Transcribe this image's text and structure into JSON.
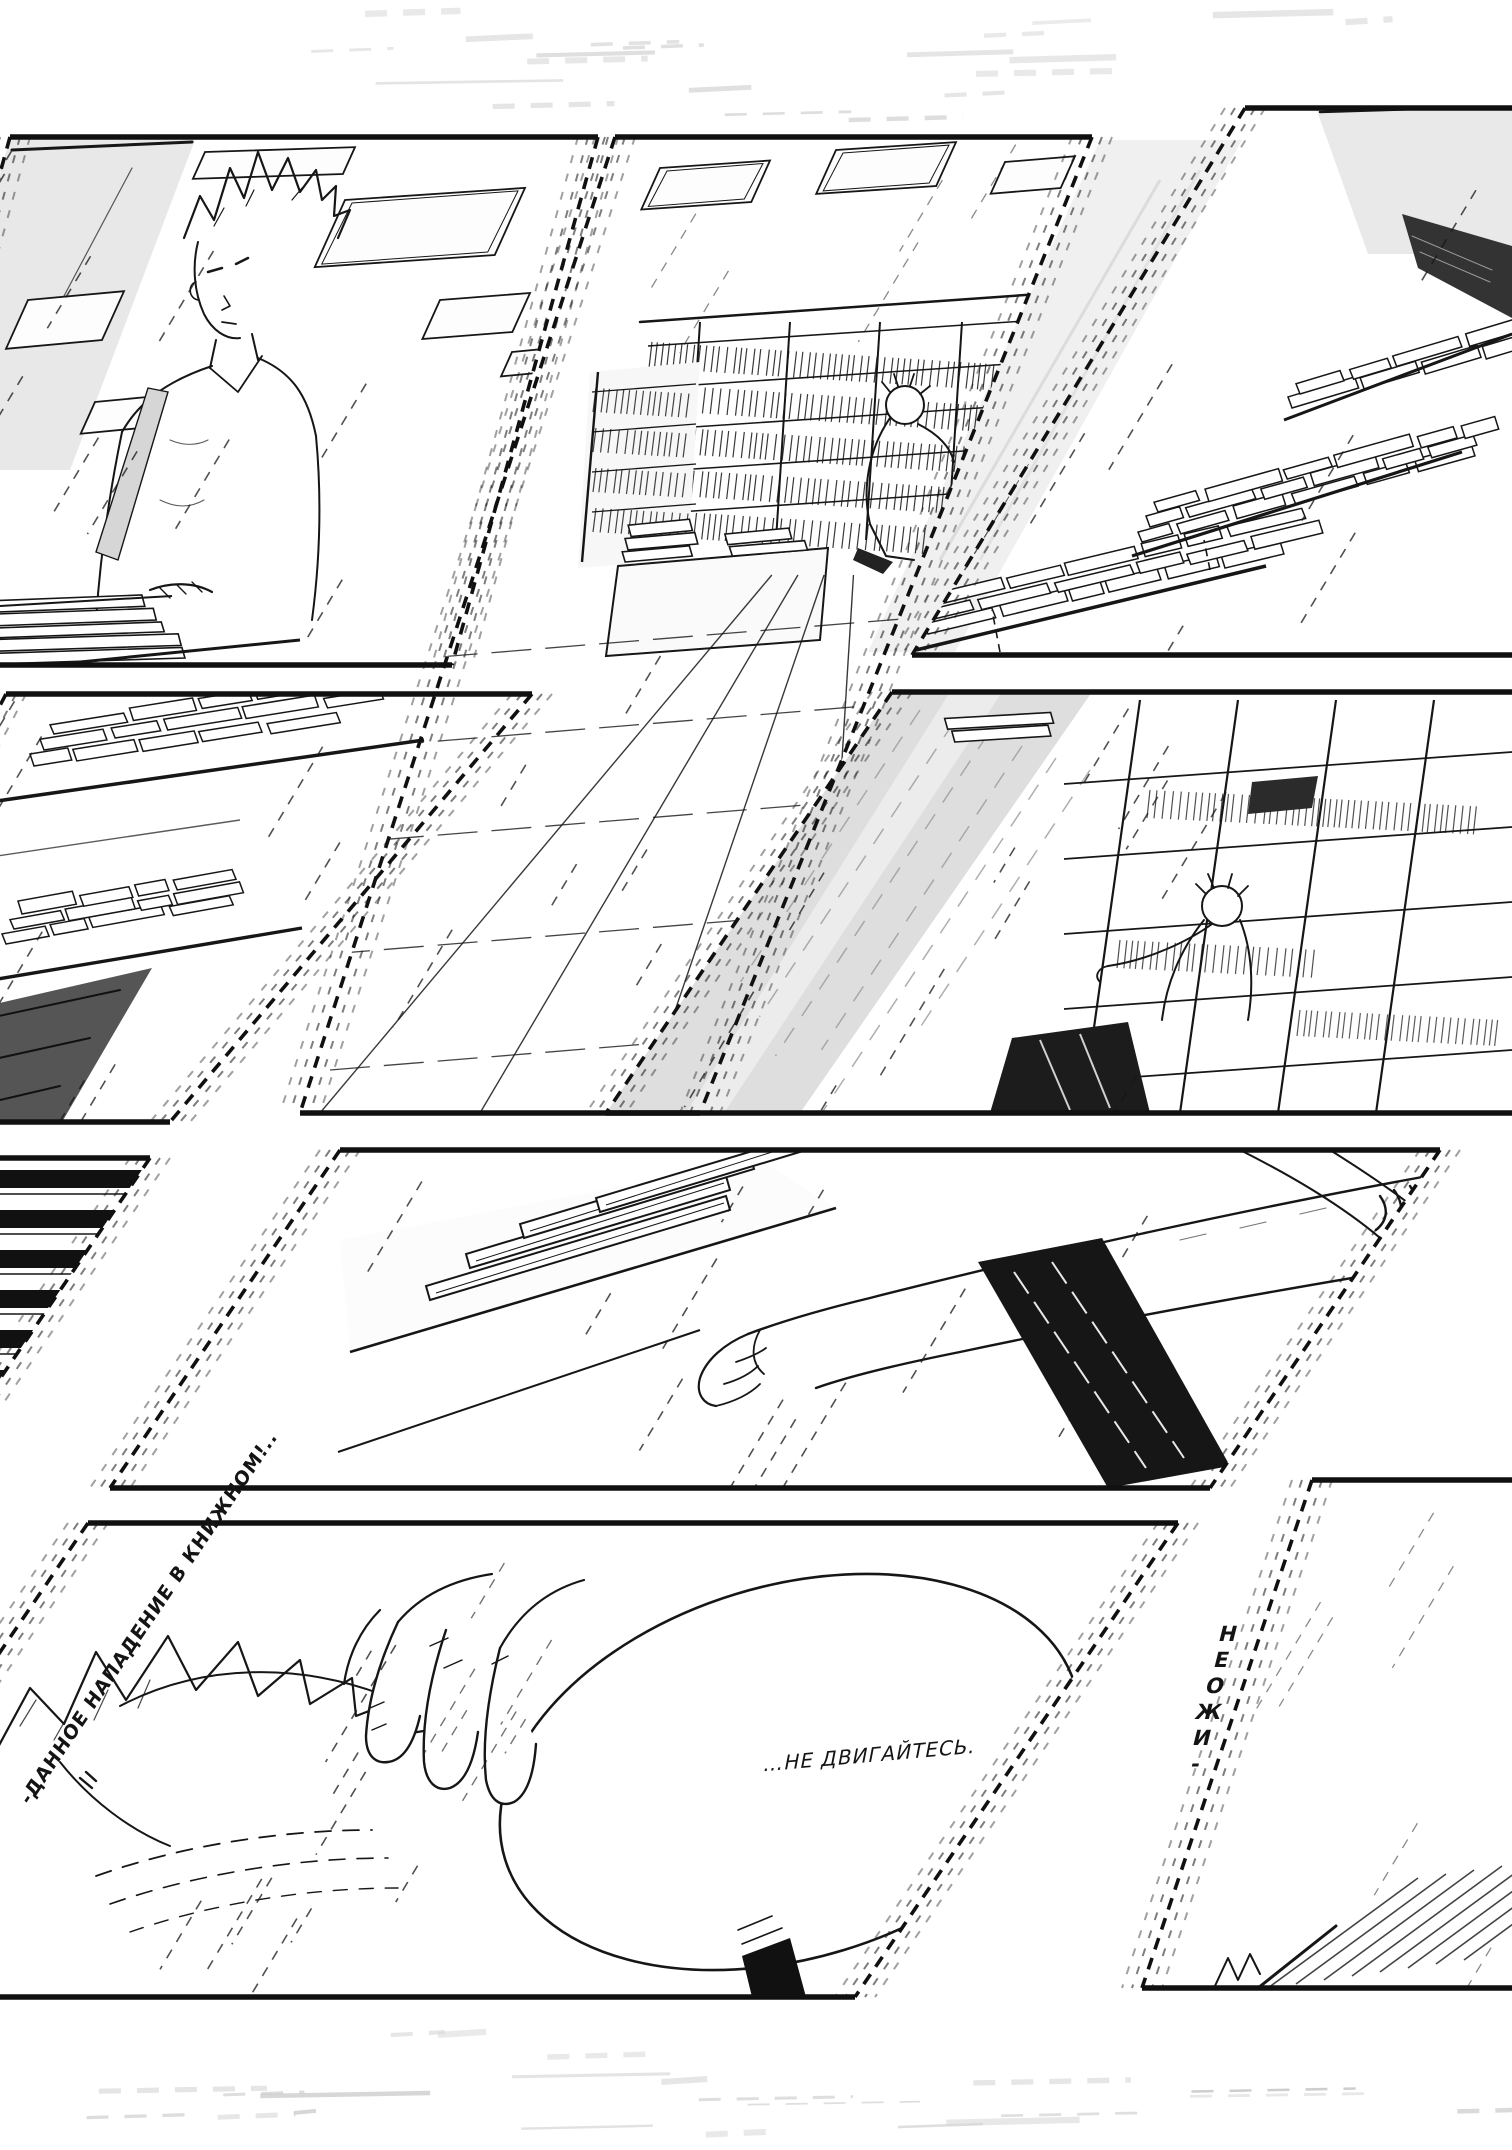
{
  "page": {
    "background": "#ffffff",
    "ink": "#161616",
    "tone_light": "#ececec",
    "tone_mid": "#dedede",
    "tone_dark": "#1a1a1a"
  },
  "texts": {
    "speech_bubble": "…НЕ ДВИГАЙТЕСЬ.",
    "gutter_caption_start": "НЕОЖИ-",
    "gutter_caption_end": "-ДАННОЕ НАПАДЕНИЕ В КНИЖНОМ!.."
  },
  "panels": [
    {
      "id": 1,
      "alt": "spiky-haired clerk standing behind a counter with a stack of books, ceiling lights above"
    },
    {
      "id": 2,
      "alt": "bookstore aisle with shelves, tiled floor and a crouching customer"
    },
    {
      "id": 3,
      "alt": "display tables covered with stacks of books"
    },
    {
      "id": 4,
      "alt": "piles of thin books on sale tables"
    },
    {
      "id": 5,
      "alt": "customer browsing a tall bookshelf beside a grey wall"
    },
    {
      "id": 6,
      "alt": "tightly packed dark book spines"
    },
    {
      "id": 7,
      "alt": "close-up of an arm and hand taking a book from a shelf, dark pinstriped sleeve"
    },
    {
      "id": 8,
      "alt": "hand reaching toward a spiky-haired head with a large speech bubble"
    },
    {
      "id": 9,
      "alt": "nearly empty corner panel with a sleeve entering from the right"
    }
  ]
}
